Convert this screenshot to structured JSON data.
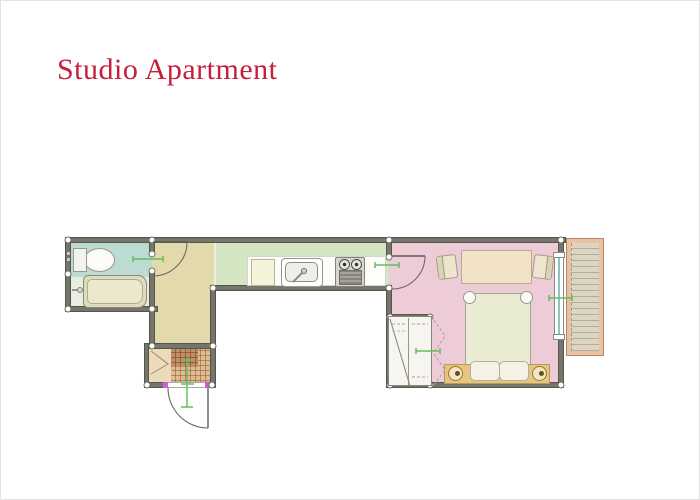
{
  "title": {
    "text": "Studio Apartment"
  },
  "colors": {
    "title": "#c5203a",
    "wall": "#76756c",
    "wallEdge": "#56554c",
    "bathroomUpper": "#bcdcd2",
    "bathroomLower": "#e7efe3",
    "hallway": "#e2daab",
    "kitchen": "#d3e5c3",
    "bedroom": "#edccd7",
    "counter": "#fdfdfa",
    "balconyFrameFill": "#e8c3a3",
    "balconyFrameEdge": "#bd835f",
    "deck": "#dcd5c3",
    "deckStripe": "#b4ac9c",
    "mat": "#d9bd93",
    "matDark": "#bd9168",
    "closet": "#ecdbba",
    "fixtureCream": "#ece8cd",
    "furnitureTan": "#f2e3c6",
    "bed": "#e9ecd3",
    "bench": "#e5c584",
    "marker": "#62bd62",
    "hinge": "#c95fd0"
  }
}
